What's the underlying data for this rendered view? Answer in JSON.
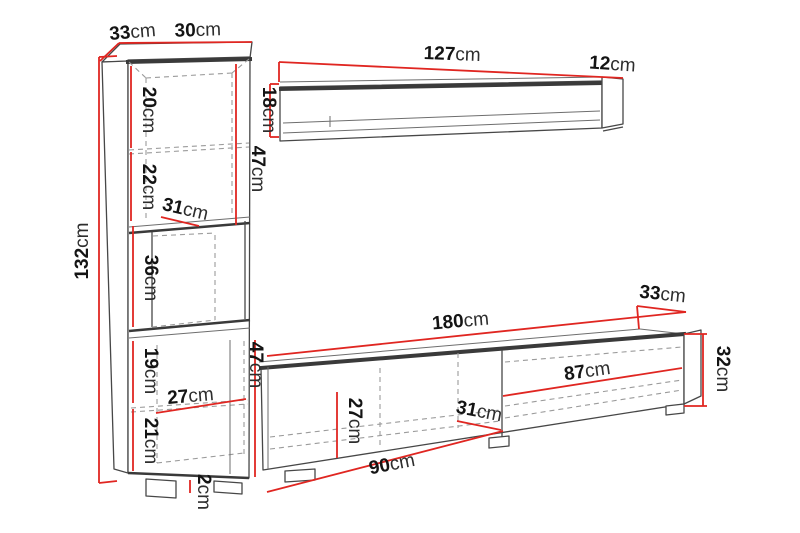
{
  "title": "Wall unit furniture dimension diagram",
  "unit": "cm",
  "colors": {
    "dimension_line": "#e02621",
    "outline": "#474747",
    "hidden_line": "#9b9b9b"
  },
  "cabinet": {
    "depth_value": "33",
    "width_value": "30",
    "height_value": "132",
    "section_1_value": "20",
    "section_2_value": "22",
    "section_3_value": "36",
    "section_4_value": "19",
    "section_5_value": "21",
    "inner_depth_value": "31",
    "inner_width_value": "27",
    "upper_inner_height_value": "47",
    "lower_inner_height_value": "47",
    "foot_height_value": "2"
  },
  "wall_shelf": {
    "length_value": "127",
    "depth_value": "12",
    "height_value": "18"
  },
  "tv_stand": {
    "length_value": "180",
    "depth_value": "33",
    "height_value": "32",
    "inner_height_value": "27",
    "inner_depth_value": "31",
    "left_inner_width_value": "90",
    "right_inner_width_value": "87"
  }
}
